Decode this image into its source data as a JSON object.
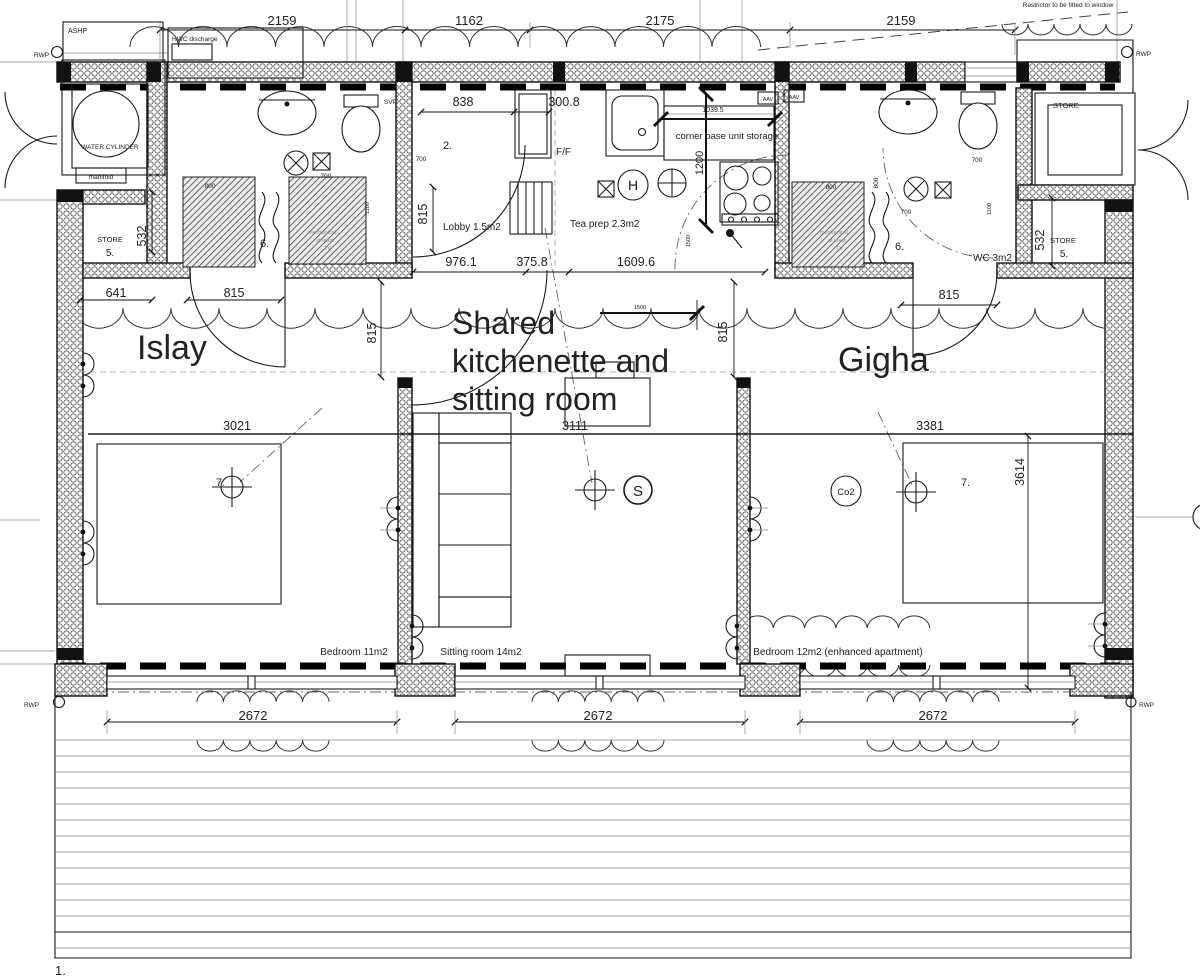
{
  "colors": {
    "red": "#d9291c",
    "line": "#1a1a1a"
  },
  "unit_labels": {
    "islay": "Islay",
    "shared_1": "Shared",
    "shared_2": "kitchenette and",
    "shared_3": "sitting room",
    "gigha": "Gigha"
  },
  "rooms": {
    "lobby": "Lobby 1.5m2",
    "tea_prep": "Tea prep 2.3m2",
    "wc": "WC 3m2",
    "bedroom_left": "Bedroom 11m2",
    "sitting_room": "Sitting room 14m2",
    "bedroom_right": "Bedroom 12m2 (enhanced apartment)",
    "store": "STORE"
  },
  "plant": {
    "ashp": "ASHP",
    "hwc_discharge": "HWC discharge",
    "water_cylinder": "WATER CYLINDER",
    "manifold": "manifold",
    "svp": "SVP",
    "aav": "AAV",
    "rwp": "RWP",
    "ff": "F/F",
    "corner_unit": "corner base unit storage"
  },
  "notes": {
    "restrictor": "Restrictor to be fitted to window",
    "mech_1": "mechanical",
    "mech_2": "at least",
    "mech_3": "TV"
  },
  "symbols": {
    "heat": "H",
    "smoke": "S",
    "co2": "Co2"
  },
  "refs": {
    "n1": "1.",
    "n2": "2.",
    "n5": "5.",
    "n6": "6.",
    "n7": "7."
  },
  "dims": {
    "d2159": "2159",
    "d1162": "1162",
    "d2175": "2175",
    "d838": "838",
    "d300_8": "300.8",
    "d1039_5": "1039.5",
    "d1200": "1200",
    "d1500": "1500",
    "d976_1": "976.1",
    "d375_8": "375.8",
    "d1609_6": "1609.6",
    "d641": "641",
    "d815": "815",
    "d532": "532",
    "d3021": "3021",
    "d3111": "3111",
    "d3381": "3381",
    "d3614": "3614",
    "d2672": "2672",
    "d700": "700",
    "d800": "800",
    "d1100": "1100"
  }
}
